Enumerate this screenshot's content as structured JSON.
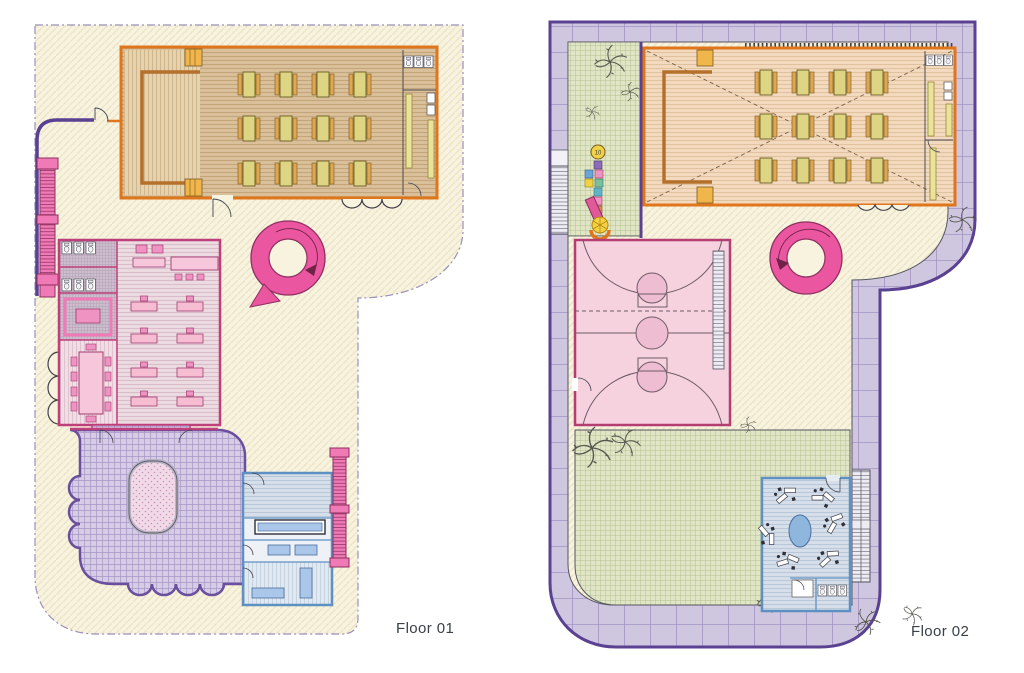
{
  "floor01": {
    "label": "Floor 01"
  },
  "floor02": {
    "label": "Floor 02",
    "hopscotch_value": "10"
  },
  "palette": {
    "slab_cream": "#f7f3df",
    "slab_hatch": "#ebe3c5",
    "boundary_dash": "#9b8fbb",
    "orange_wall": "#e0761c",
    "stage_bracket": "#b5702c",
    "wood_floor": "#d9c09a",
    "stage_floor": "#e5d3b0",
    "table_top_yellow": "#ddd584",
    "table_side_orange": "#dfa751",
    "step_yellow": "#f0b64c",
    "bench_yellow": "#e9e49a",
    "crimson_wall": "#bf3f7a",
    "pink_floor": "#ecdae1",
    "pink_furniture": "#ef93c2",
    "pink_furniture_light": "#f6c6da",
    "magenta_stair": "#f07ab5",
    "ramp_pink": "#ea57a0",
    "purple_wall": "#5a4192",
    "play_floor": "#d6cde5",
    "ballpit_fill": "#f2d9e8",
    "blue_wall": "#5f90c2",
    "blue_floor": "#d6dfe9",
    "blue_furniture": "#aac6e8",
    "terrace_lavender": "#cfc7df",
    "terrace_joint": "#a293c2",
    "garden_green": "#e0e5c5",
    "court_pink": "#f5d2de",
    "court_marking": "#6e5a66",
    "rug_blue": "#8fb6dc",
    "plant_line": "#55564e",
    "label_text": "#3a4148"
  }
}
